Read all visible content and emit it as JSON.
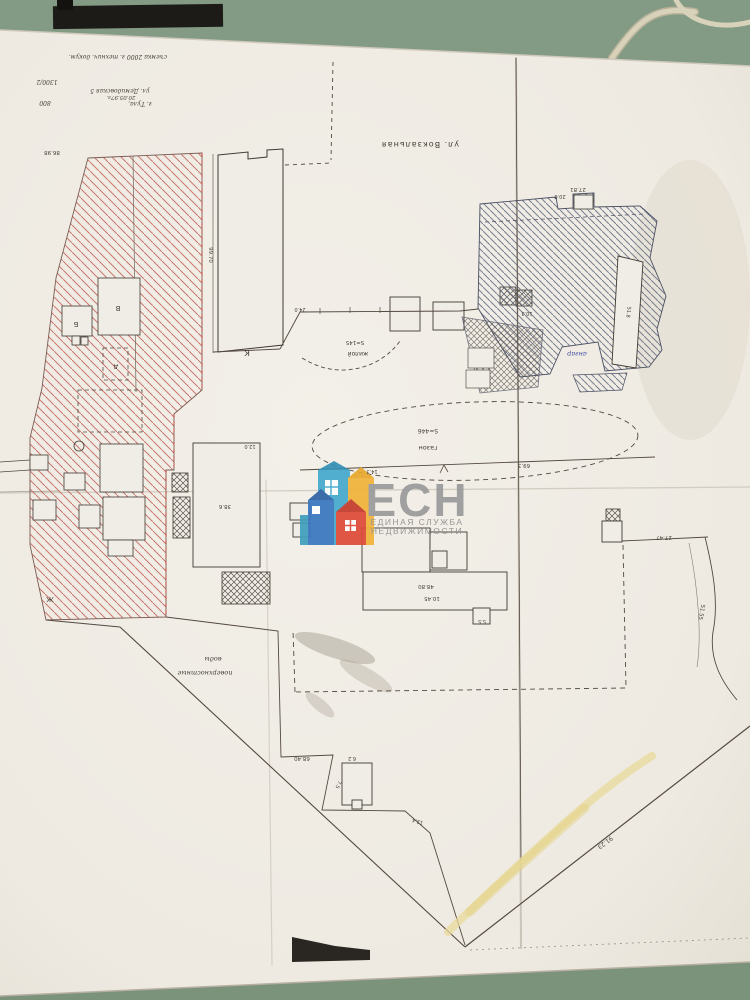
{
  "scene": {
    "description": "Photo of a paper cadastral site plan lying on a green table",
    "table_color": "#8aa08c",
    "paper_color": "#f0ede6",
    "cable_color": "#d8d2ba",
    "black_bar_color": "#1d1b18"
  },
  "plan": {
    "ink": "#453f37",
    "hatch_red": "#c2635c",
    "hatch_blue": "#6b7287",
    "highlight_yellow": "#e8da9b",
    "boundary_color": "#53493f"
  },
  "watermark": {
    "logo_text": "ЕСН",
    "subtitle_line1": "ЕДИНАЯ СЛУЖБА",
    "subtitle_line2": "НЕДВИЖИМОСТИ",
    "text_color": "#9b9b9b",
    "subtitle_color": "#8f8f8f",
    "house_colors": [
      "#45aacd",
      "#3a77c0",
      "#f0b23a",
      "#df4b38",
      "#3f9fbe"
    ]
  },
  "plan_labels": [
    {
      "text": "съемка 2000 г. технич. докум.",
      "x": 118,
      "y": 55,
      "rot": 180,
      "size": 6,
      "font": "hand"
    },
    {
      "text": "1300/2",
      "x": 47,
      "y": 80,
      "rot": 180,
      "size": 6,
      "font": "hand"
    },
    {
      "text": "ул. Демидовская 5",
      "x": 120,
      "y": 89,
      "rot": 180,
      "size": 6,
      "font": "hand"
    },
    {
      "text": "20.05.97г.",
      "x": 121,
      "y": 96,
      "rot": 180,
      "size": 5.5,
      "font": "hand"
    },
    {
      "text": "г. Тула,",
      "x": 140,
      "y": 102,
      "rot": 180,
      "size": 6,
      "font": "hand"
    },
    {
      "text": "800",
      "x": 45,
      "y": 101,
      "rot": 180,
      "size": 6,
      "font": "hand"
    },
    {
      "text": "ул. Вокзальная",
      "x": 420,
      "y": 142,
      "rot": 180,
      "size": 8,
      "ls": 1
    },
    {
      "text": "86.98",
      "x": 52,
      "y": 151,
      "rot": 180,
      "size": 5.5
    },
    {
      "text": "99.70",
      "x": 209,
      "y": 255,
      "rot": 90,
      "size": 5.5
    },
    {
      "text": "К",
      "x": 247,
      "y": 350,
      "rot": 180,
      "size": 8
    },
    {
      "text": "27.81",
      "x": 578,
      "y": 188,
      "rot": 180,
      "size": 5.5
    },
    {
      "text": "20.0",
      "x": 560,
      "y": 195,
      "rot": 180,
      "size": 5
    },
    {
      "text": "жилой",
      "x": 358,
      "y": 352,
      "rot": 180,
      "size": 6
    },
    {
      "text": "S=145",
      "x": 355,
      "y": 341,
      "rot": 180,
      "size": 5.5
    },
    {
      "text": "газон",
      "x": 428,
      "y": 446,
      "rot": 180,
      "size": 6.5
    },
    {
      "text": "S=446",
      "x": 428,
      "y": 429,
      "rot": 180,
      "size": 6
    },
    {
      "text": "69.3",
      "x": 524,
      "y": 464,
      "rot": 180,
      "size": 5.5
    },
    {
      "text": "14.3",
      "x": 372,
      "y": 470,
      "rot": 180,
      "size": 5
    },
    {
      "text": "27.47",
      "x": 664,
      "y": 536,
      "rot": 180,
      "size": 5.5
    },
    {
      "text": "91.23",
      "x": 604,
      "y": 841,
      "rot": 143,
      "size": 6
    },
    {
      "text": "51.55",
      "x": 700,
      "y": 612,
      "rot": 100,
      "size": 5.5
    },
    {
      "text": "воды",
      "x": 213,
      "y": 657,
      "rot": 180,
      "size": 6.5,
      "font": "hand"
    },
    {
      "text": "поверхностные",
      "x": 205,
      "y": 671,
      "rot": 180,
      "size": 6.5,
      "font": "hand"
    },
    {
      "text": "ангар",
      "x": 577,
      "y": 352,
      "rot": 180,
      "size": 6.5,
      "color": "#3b4a9e",
      "font": "hand"
    },
    {
      "text": "Б",
      "x": 76,
      "y": 322,
      "rot": 180,
      "size": 7
    },
    {
      "text": "В",
      "x": 118,
      "y": 306,
      "rot": 180,
      "size": 7
    },
    {
      "text": "д",
      "x": 116,
      "y": 365,
      "rot": 180,
      "size": 7
    },
    {
      "text": "Ж",
      "x": 50,
      "y": 597,
      "rot": 180,
      "size": 7
    },
    {
      "text": "10.45",
      "x": 432,
      "y": 597,
      "rot": 180,
      "size": 5.5
    },
    {
      "text": "48.80",
      "x": 426,
      "y": 585,
      "rot": 180,
      "size": 5.5
    },
    {
      "text": "5.5",
      "x": 482,
      "y": 620,
      "rot": 180,
      "size": 5
    },
    {
      "text": "38.6",
      "x": 225,
      "y": 505,
      "rot": 180,
      "size": 5.5
    },
    {
      "text": "12.0",
      "x": 250,
      "y": 445,
      "rot": 180,
      "size": 5
    },
    {
      "text": "10.3",
      "x": 527,
      "y": 312,
      "rot": 180,
      "size": 5
    },
    {
      "text": "51.8",
      "x": 627,
      "y": 312,
      "rot": 96,
      "size": 5
    },
    {
      "text": "68.40",
      "x": 302,
      "y": 757,
      "rot": 180,
      "size": 5.5
    },
    {
      "text": "6.2",
      "x": 352,
      "y": 757,
      "rot": 180,
      "size": 5
    },
    {
      "text": "7.5",
      "x": 337,
      "y": 784,
      "rot": 115,
      "size": 5
    },
    {
      "text": "12.4",
      "x": 418,
      "y": 820,
      "rot": 195,
      "size": 5
    },
    {
      "text": "24.0",
      "x": 300,
      "y": 308,
      "rot": 180,
      "size": 5
    }
  ]
}
